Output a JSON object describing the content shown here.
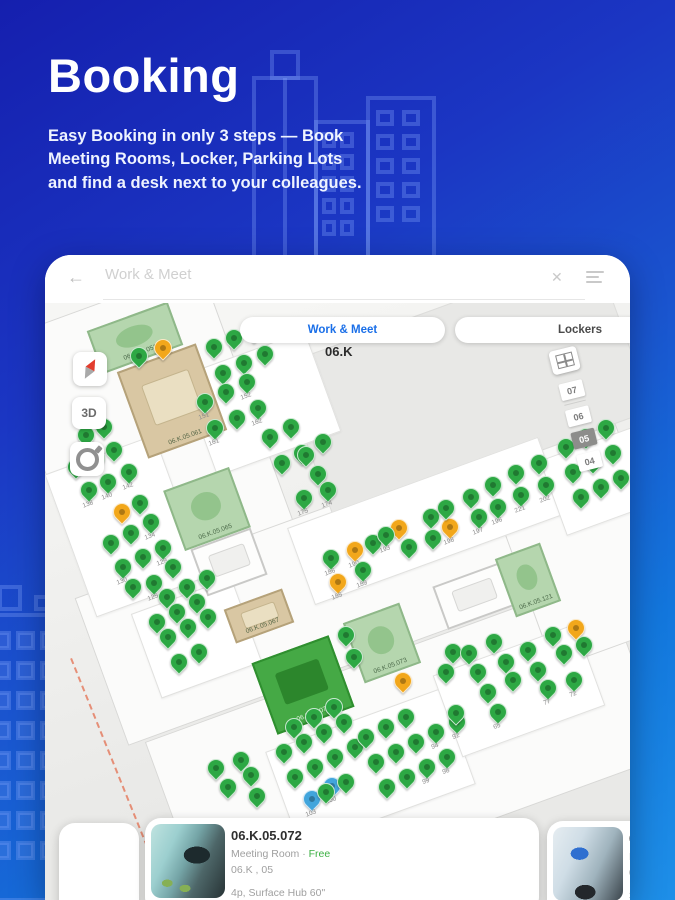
{
  "hero": {
    "title": "Booking",
    "subtitle_lines": [
      "Easy Booking in only 3 steps — Book",
      "Meeting Rooms, Locker, Parking Lots",
      "and find a desk next to your colleagues."
    ]
  },
  "app": {
    "search": {
      "back_icon": "←",
      "placeholder": "Work & Meet",
      "clear_icon": "✕"
    },
    "tabs": [
      {
        "label": "Work & Meet",
        "active": true
      },
      {
        "label": "Lockers",
        "active": false
      }
    ],
    "floor_label": "06.K",
    "map_controls": {
      "three_d_label": "3D"
    },
    "floor_selector": {
      "floors": [
        "07",
        "06",
        "05",
        "04"
      ],
      "selected": "05"
    },
    "pin_colors": {
      "g": "#2da844",
      "o": "#f2a71b",
      "b": "#42a5dc"
    },
    "rooms": [
      {
        "x": 47,
        "y": 60,
        "w": 86,
        "h": 46,
        "type": "meeting-available",
        "label": "06.K.05.051"
      },
      {
        "x": 85,
        "y": 100,
        "w": 84,
        "h": 92,
        "type": "meeting-classic",
        "label": "06.K.05.061"
      },
      {
        "x": 127,
        "y": 222,
        "w": 70,
        "h": 64,
        "type": "meeting-available",
        "label": "06.K.05.065"
      },
      {
        "x": 152,
        "y": 282,
        "w": 64,
        "h": 50,
        "type": "meeting-white",
        "label": ""
      },
      {
        "x": 183,
        "y": 343,
        "w": 62,
        "h": 36,
        "type": "meeting-classic",
        "label": "06.K.05.067"
      },
      {
        "x": 217,
        "y": 392,
        "w": 82,
        "h": 76,
        "type": "meeting-selected",
        "label": "06.K.05.072"
      },
      {
        "x": 307,
        "y": 356,
        "w": 60,
        "h": 64,
        "type": "meeting-available",
        "label": "06.K.05.073"
      },
      {
        "x": 393,
        "y": 318,
        "w": 72,
        "h": 46,
        "type": "meeting-white",
        "label": ""
      },
      {
        "x": 459,
        "y": 294,
        "w": 48,
        "h": 62,
        "type": "meeting-available",
        "label": "06.K.05.121"
      }
    ],
    "pins": [
      [
        117,
        103,
        "o",
        ""
      ],
      [
        76,
        267,
        "o",
        ""
      ],
      [
        309,
        305,
        "o",
        "190"
      ],
      [
        353,
        283,
        "o",
        ""
      ],
      [
        404,
        282,
        "o",
        "198"
      ],
      [
        292,
        337,
        "o",
        "185"
      ],
      [
        357,
        436,
        "o",
        ""
      ],
      [
        530,
        383,
        "o",
        ""
      ],
      [
        266,
        554,
        "b",
        "103"
      ],
      [
        286,
        541,
        "b",
        "100"
      ],
      [
        93,
        111,
        "g",
        ""
      ],
      [
        168,
        102,
        "g",
        ""
      ],
      [
        188,
        93,
        "g",
        ""
      ],
      [
        208,
        86,
        "g",
        ""
      ],
      [
        177,
        128,
        "g",
        ""
      ],
      [
        198,
        118,
        "g",
        ""
      ],
      [
        219,
        109,
        "g",
        ""
      ],
      [
        159,
        157,
        "g",
        "151"
      ],
      [
        180,
        147,
        "g",
        ""
      ],
      [
        201,
        137,
        "g",
        "152"
      ],
      [
        169,
        183,
        "g",
        "161"
      ],
      [
        191,
        173,
        "g",
        ""
      ],
      [
        212,
        163,
        "g",
        "162"
      ],
      [
        224,
        192,
        "g",
        ""
      ],
      [
        245,
        182,
        "g",
        ""
      ],
      [
        236,
        218,
        "g",
        ""
      ],
      [
        256,
        208,
        "g",
        ""
      ],
      [
        277,
        197,
        "g",
        ""
      ],
      [
        40,
        190,
        "g",
        ""
      ],
      [
        58,
        182,
        "g",
        ""
      ],
      [
        30,
        222,
        "g",
        ""
      ],
      [
        50,
        213,
        "g",
        ""
      ],
      [
        68,
        205,
        "g",
        ""
      ],
      [
        83,
        227,
        "g",
        "142"
      ],
      [
        43,
        245,
        "g",
        "138"
      ],
      [
        62,
        237,
        "g",
        "140"
      ],
      [
        94,
        258,
        "g",
        ""
      ],
      [
        105,
        277,
        "g",
        "134"
      ],
      [
        85,
        288,
        "g",
        ""
      ],
      [
        65,
        298,
        "g",
        ""
      ],
      [
        117,
        303,
        "g",
        "129"
      ],
      [
        97,
        312,
        "g",
        ""
      ],
      [
        77,
        322,
        "g",
        "130"
      ],
      [
        108,
        338,
        "g",
        "125"
      ],
      [
        127,
        322,
        "g",
        ""
      ],
      [
        87,
        342,
        "g",
        ""
      ],
      [
        121,
        352,
        "g",
        ""
      ],
      [
        141,
        342,
        "g",
        ""
      ],
      [
        161,
        333,
        "g",
        ""
      ],
      [
        111,
        377,
        "g",
        ""
      ],
      [
        131,
        367,
        "g",
        ""
      ],
      [
        151,
        357,
        "g",
        ""
      ],
      [
        122,
        392,
        "g",
        ""
      ],
      [
        142,
        382,
        "g",
        ""
      ],
      [
        162,
        372,
        "g",
        ""
      ],
      [
        133,
        417,
        "g",
        ""
      ],
      [
        153,
        407,
        "g",
        ""
      ],
      [
        260,
        210,
        "g",
        ""
      ],
      [
        272,
        229,
        "g",
        ""
      ],
      [
        258,
        253,
        "g",
        "175"
      ],
      [
        282,
        245,
        "g",
        "174"
      ],
      [
        285,
        313,
        "g",
        "186"
      ],
      [
        317,
        325,
        "g",
        "189"
      ],
      [
        327,
        298,
        "g",
        ""
      ],
      [
        340,
        290,
        "g",
        "193"
      ],
      [
        363,
        302,
        "g",
        ""
      ],
      [
        385,
        272,
        "g",
        ""
      ],
      [
        387,
        293,
        "g",
        ""
      ],
      [
        400,
        263,
        "g",
        ""
      ],
      [
        425,
        252,
        "g",
        ""
      ],
      [
        433,
        272,
        "g",
        "197"
      ],
      [
        447,
        240,
        "g",
        ""
      ],
      [
        452,
        262,
        "g",
        "196"
      ],
      [
        470,
        228,
        "g",
        ""
      ],
      [
        475,
        250,
        "g",
        "221"
      ],
      [
        493,
        218,
        "g",
        ""
      ],
      [
        500,
        240,
        "g",
        "202"
      ],
      [
        520,
        202,
        "g",
        ""
      ],
      [
        540,
        192,
        "g",
        ""
      ],
      [
        560,
        183,
        "g",
        ""
      ],
      [
        527,
        227,
        "g",
        ""
      ],
      [
        547,
        217,
        "g",
        ""
      ],
      [
        567,
        208,
        "g",
        ""
      ],
      [
        535,
        252,
        "g",
        ""
      ],
      [
        555,
        242,
        "g",
        ""
      ],
      [
        575,
        233,
        "g",
        ""
      ],
      [
        248,
        482,
        "g",
        ""
      ],
      [
        268,
        472,
        "g",
        ""
      ],
      [
        288,
        462,
        "g",
        ""
      ],
      [
        238,
        507,
        "g",
        ""
      ],
      [
        258,
        497,
        "g",
        ""
      ],
      [
        278,
        487,
        "g",
        ""
      ],
      [
        298,
        477,
        "g",
        ""
      ],
      [
        249,
        532,
        "g",
        ""
      ],
      [
        269,
        522,
        "g",
        ""
      ],
      [
        289,
        512,
        "g",
        ""
      ],
      [
        309,
        502,
        "g",
        ""
      ],
      [
        280,
        547,
        "g",
        ""
      ],
      [
        300,
        537,
        "g",
        ""
      ],
      [
        320,
        492,
        "g",
        ""
      ],
      [
        340,
        482,
        "g",
        ""
      ],
      [
        360,
        472,
        "g",
        ""
      ],
      [
        330,
        517,
        "g",
        ""
      ],
      [
        350,
        507,
        "g",
        ""
      ],
      [
        370,
        497,
        "g",
        ""
      ],
      [
        390,
        487,
        "g",
        "94"
      ],
      [
        341,
        542,
        "g",
        ""
      ],
      [
        361,
        532,
        "g",
        ""
      ],
      [
        381,
        522,
        "g",
        "99"
      ],
      [
        401,
        512,
        "g",
        "98"
      ],
      [
        411,
        477,
        "g",
        "92"
      ],
      [
        407,
        407,
        "g",
        ""
      ],
      [
        400,
        427,
        "g",
        ""
      ],
      [
        423,
        408,
        "g",
        ""
      ],
      [
        432,
        427,
        "g",
        ""
      ],
      [
        442,
        447,
        "g",
        ""
      ],
      [
        448,
        397,
        "g",
        ""
      ],
      [
        460,
        417,
        "g",
        ""
      ],
      [
        467,
        435,
        "g",
        ""
      ],
      [
        482,
        405,
        "g",
        ""
      ],
      [
        492,
        425,
        "g",
        ""
      ],
      [
        502,
        443,
        "g",
        "77"
      ],
      [
        507,
        390,
        "g",
        ""
      ],
      [
        518,
        408,
        "g",
        ""
      ],
      [
        528,
        435,
        "g",
        "72"
      ],
      [
        538,
        400,
        "g",
        ""
      ],
      [
        452,
        467,
        "g",
        "65"
      ],
      [
        410,
        468,
        "g",
        ""
      ],
      [
        300,
        390,
        "g",
        ""
      ],
      [
        308,
        412,
        "g",
        ""
      ],
      [
        170,
        523,
        "g",
        ""
      ],
      [
        195,
        515,
        "g",
        ""
      ],
      [
        205,
        530,
        "g",
        ""
      ],
      [
        182,
        542,
        "g",
        ""
      ],
      [
        211,
        551,
        "g",
        ""
      ]
    ],
    "cards": {
      "main": {
        "title": "06.K.05.072",
        "type": "Meeting Room",
        "separator": " · ",
        "status": "Free",
        "location": "06.K , 05",
        "equipment": "4p, Surface Hub 60\""
      },
      "right_partial": {
        "title": "06.K",
        "line1": "Meet",
        "line2": "06.K",
        "line3": "32\" T"
      }
    }
  }
}
